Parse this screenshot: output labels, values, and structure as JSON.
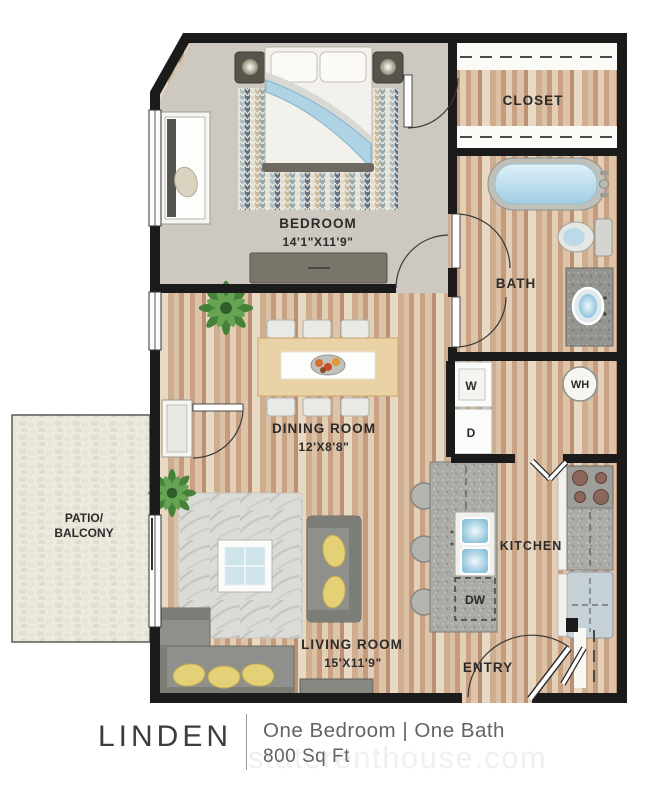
{
  "plan": {
    "rooms": {
      "bedroom": {
        "label": "BEDROOM",
        "dims": "14'1\"X11'9\""
      },
      "closet": {
        "label": "CLOSET"
      },
      "bath": {
        "label": "BATH"
      },
      "dining_room": {
        "label": "DINING ROOM",
        "dims": "12'X8'8\""
      },
      "kitchen": {
        "label": "KITCHEN"
      },
      "living_room": {
        "label": "LIVING ROOM",
        "dims": "15'X11'9\""
      },
      "entry": {
        "label": "ENTRY"
      },
      "patio": {
        "label_line1": "PATIO/",
        "label_line2": "BALCONY"
      }
    },
    "appliances": {
      "washer": "W",
      "dryer": "D",
      "water_heater": "WH",
      "dishwasher": "DW"
    }
  },
  "footer": {
    "title": "LINDEN",
    "subtitle": "One Bedroom | One Bath",
    "area": "800 Sq Ft",
    "watermark": "staterenthouse.com"
  },
  "colors": {
    "wall": "#1b1b1b",
    "wood_floor": "#d3b69c",
    "bedroom_carpet": "#cdc9c1",
    "patio_stone": "#eceade",
    "tub_water": "#aed3e5",
    "pillow_yellow": "#e3d077",
    "plant_green": "#44823a",
    "sofa_gray": "#8f8f8b"
  }
}
